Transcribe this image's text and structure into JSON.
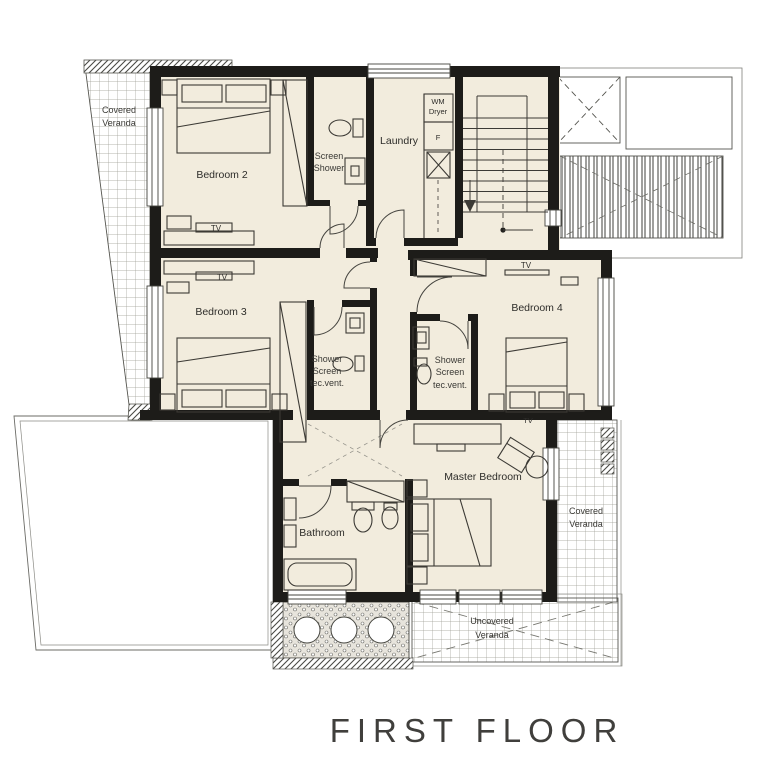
{
  "title": "FIRST FLOOR",
  "labels": {
    "veranda_tl_1": "Covered",
    "veranda_tl_2": "Veranda",
    "bedroom2": "Bedroom 2",
    "screen_shower_1": "Screen",
    "screen_shower_2": "Shower",
    "laundry": "Laundry",
    "wm_1": "WM",
    "wm_2": "Dryer",
    "f": "F",
    "tv": "TV",
    "bedroom3": "Bedroom 3",
    "shower_screen_1": "Shower",
    "shower_screen_2": "Screen",
    "shower_screen_3": "tec.vent.",
    "bedroom4": "Bedroom 4",
    "master": "Master Bedroom",
    "bathroom": "Bathroom",
    "veranda_r_1": "Covered",
    "veranda_r_2": "Veranda",
    "uncovered_1": "Uncovered",
    "uncovered_2": "Veranda"
  },
  "colors": {
    "room_fill": "#f2ecdd",
    "wall": "#1d1c19",
    "furniture_line": "#3c3a35",
    "outside_line": "#6b6b66",
    "text": "#2e2d2a"
  }
}
